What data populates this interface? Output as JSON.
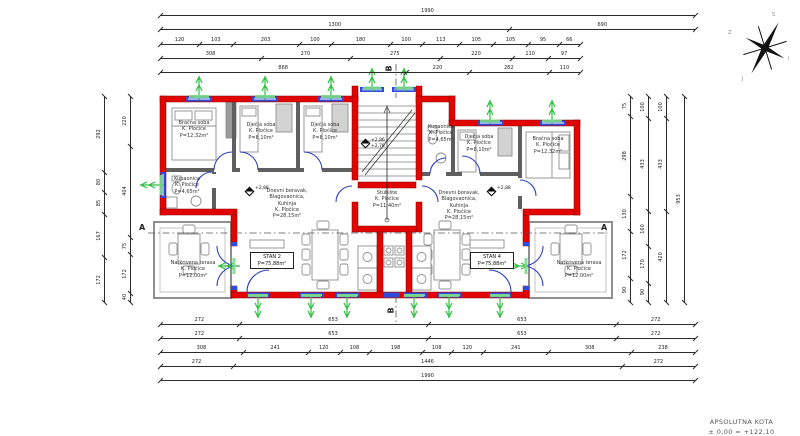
{
  "rooms": {
    "left": {
      "master": "Bračna soba\nK. Pločice\nP=12,32m²",
      "kids1": "Dječja soba\nK. Pločice\nP=8,10m²",
      "kids2": "Dječja soba\nK. Pločice\nP=8,10m²",
      "bath": "Kupaonica\nK. Pločice\nP=4,65m²",
      "living": "Dnevni boravak,\nBlagovaonica,\nKuhinja\nK. Pločice\nP=28,15m²",
      "unit": "STAN 2\nP=75,88m²",
      "terrace": "Natkrivena terasa\nK. Pločice\nP=12,00m²"
    },
    "center": {
      "stairs": "Stubište\nK. Pločice\nP=11,40m²"
    },
    "right": {
      "bath": "Kupaonica\nK. Pločice\nP=4,65m²",
      "kids": "Dječja soba\nK. Pločice\nP=8,10m²",
      "master": "Bračna soba\nK. Pločice\nP=12,32m²",
      "living": "Dnevni boravak,\nBlagovaonica,\nKuhinja\nK. Pločice\nP=28,15m²",
      "unit": "STAN 4\nP=75,88m²",
      "terrace": "Natkrivena terasa\nK. Pločice\nP=12,00m²"
    }
  },
  "elevations": {
    "stair": "+2,86\n+2,79",
    "left_unit": "+2,88",
    "right_unit": "+2,88"
  },
  "markers": {
    "section_a": "A",
    "section_b": "B"
  },
  "compass": {
    "n": "S",
    "e": "I",
    "s": "J",
    "w": "Z"
  },
  "footer": {
    "line1": "APSOLUTNA KOTA",
    "line2": "± 0,00 = +122,10"
  },
  "dimensions": {
    "top": [
      [
        "1990"
      ],
      [
        "1300",
        "690"
      ],
      [
        "120",
        "103",
        "203",
        "100",
        "180",
        "100",
        "113",
        "105",
        "105",
        "95",
        "66"
      ],
      [
        "308",
        "270",
        "275",
        "220",
        "110",
        "97"
      ],
      [
        "868",
        "220",
        "282",
        "110"
      ]
    ],
    "bottom": [
      [
        "272",
        "653",
        "653",
        "272"
      ],
      [
        "272",
        "653",
        "653",
        "272"
      ],
      [
        "308",
        "241",
        "120",
        "108",
        "198",
        "108",
        "120",
        "241",
        "308",
        "238"
      ],
      [
        "272",
        "1446",
        "272"
      ],
      [
        "1990"
      ]
    ],
    "left": [
      [
        "292",
        "80",
        "85",
        "167",
        "172"
      ],
      [
        "220",
        "404",
        "75",
        "172",
        "40"
      ]
    ],
    "right": [
      [
        "75",
        "298",
        "130",
        "172",
        "90"
      ],
      [
        "100",
        "433",
        "160",
        "170",
        "90"
      ],
      [
        "100",
        "433",
        "420"
      ],
      [
        "953"
      ]
    ]
  },
  "colors": {
    "wall": "#e10400",
    "interior_wall": "#5f5f5f",
    "window": "#2e4bdb",
    "door": "#2d3fc0",
    "opening_arrow": "#2fbf3f"
  }
}
